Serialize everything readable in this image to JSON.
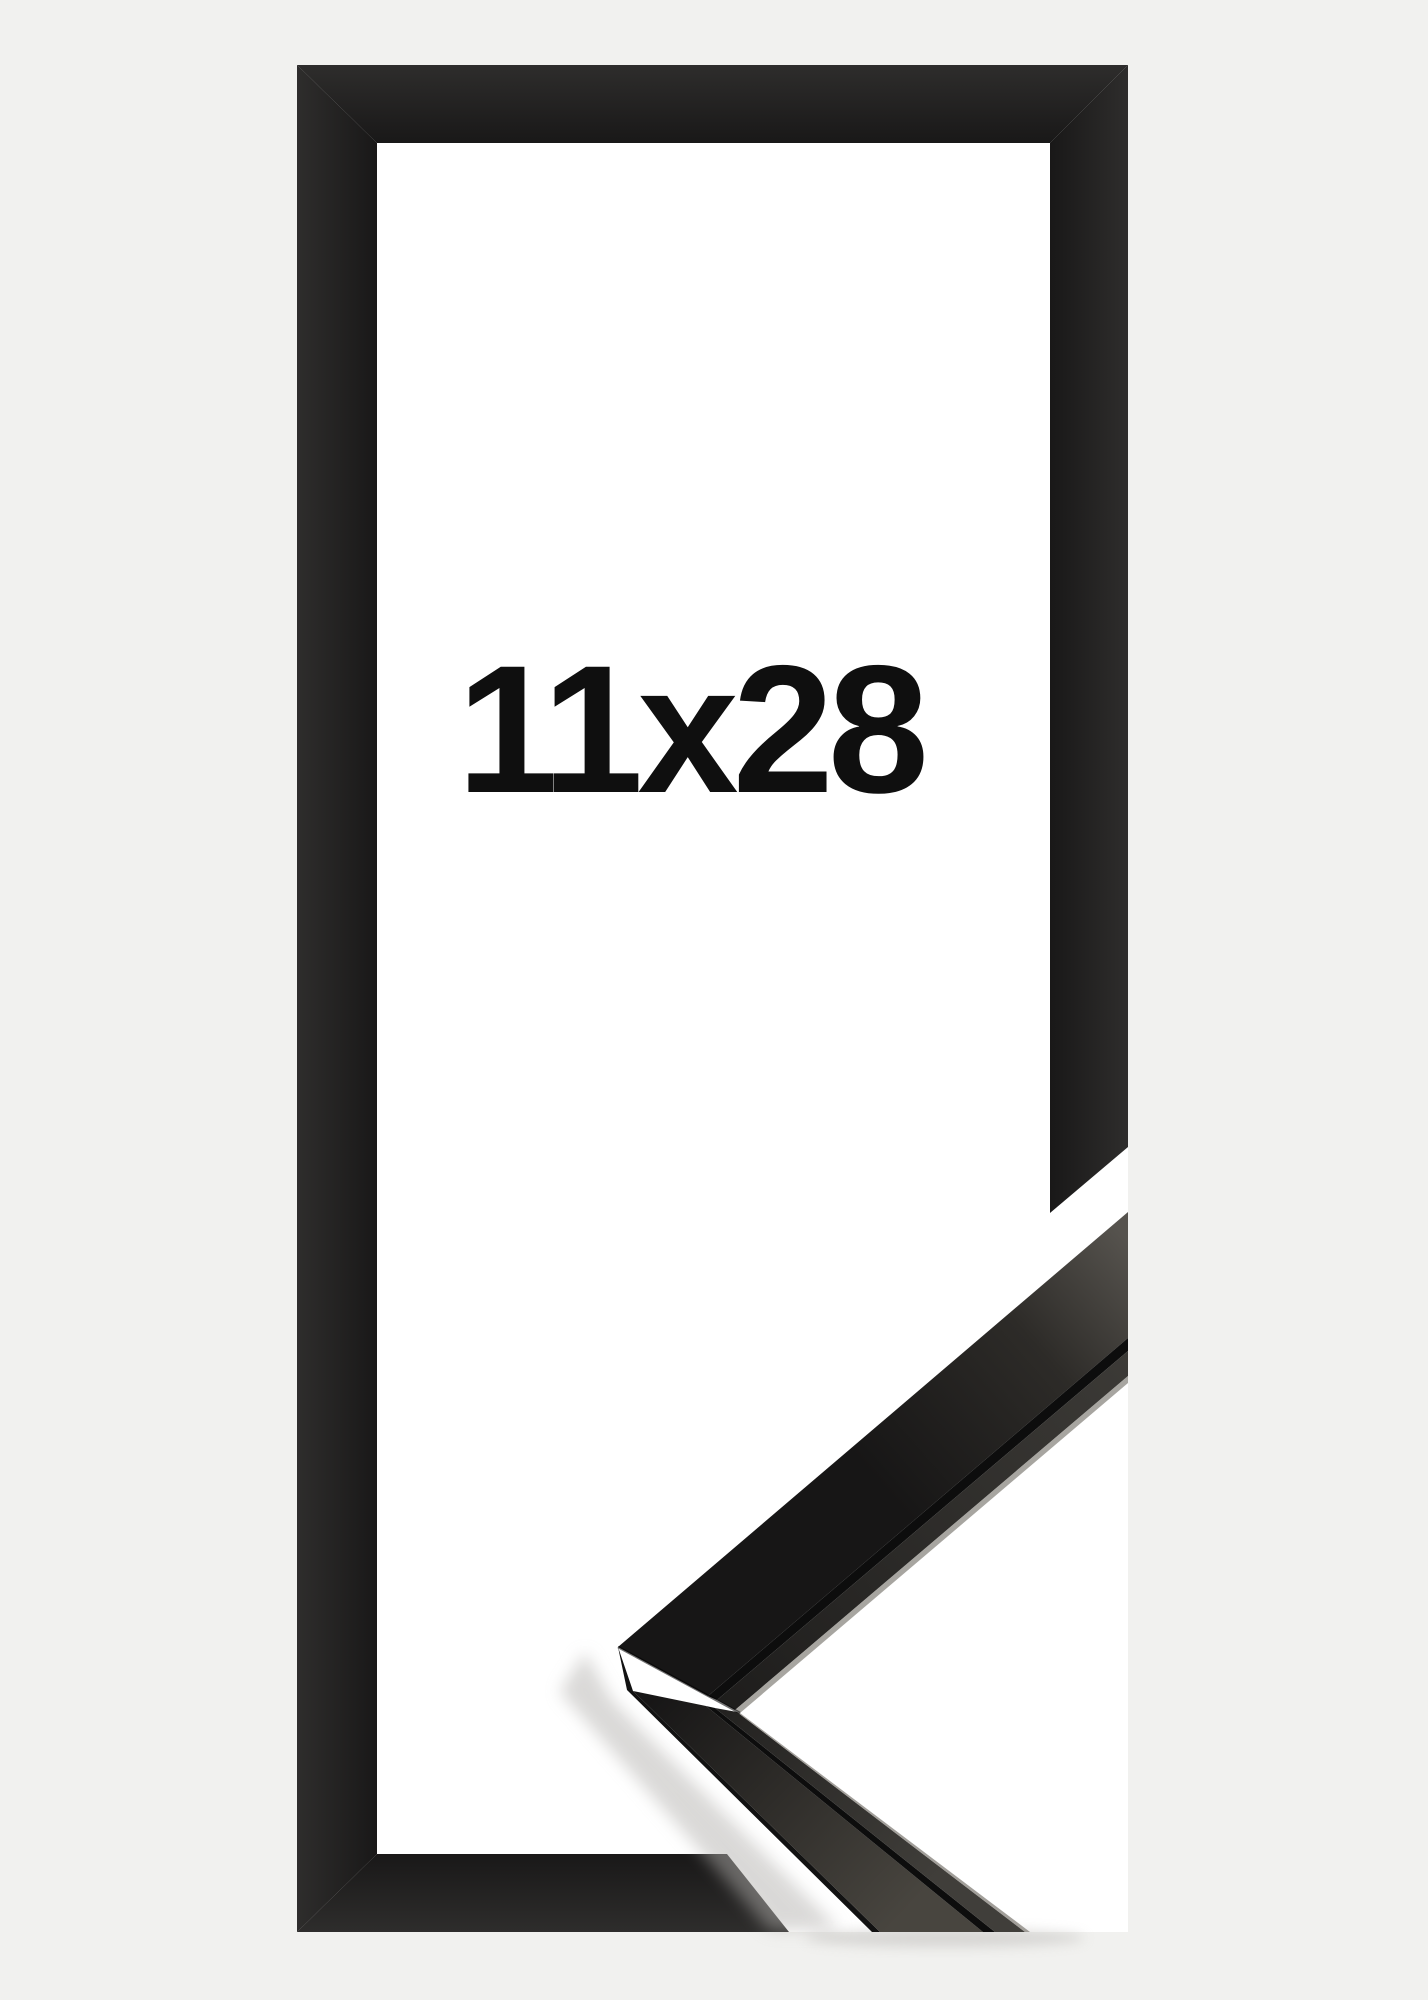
{
  "product": {
    "size_label": "11x28"
  },
  "icons": {},
  "colors": {
    "background": "#f1f1ef",
    "opening": "#ffffff",
    "label": "#0f0f0f",
    "frame_edge": "#2e2d2c",
    "frame_face": "#191818",
    "profile_end_light": "#56534e",
    "profile_face_mid": "#2d2b28",
    "profile_face_dark": "#171616",
    "profile_face_light": "#48453f",
    "lip_light": "#403e3a",
    "lip_dark": "#1d1c1b",
    "groove": "#0d0d0d",
    "side_edge": "#121212",
    "highlight": "#98958f",
    "seam": "#000000",
    "shadow": "#b5b3b0"
  }
}
